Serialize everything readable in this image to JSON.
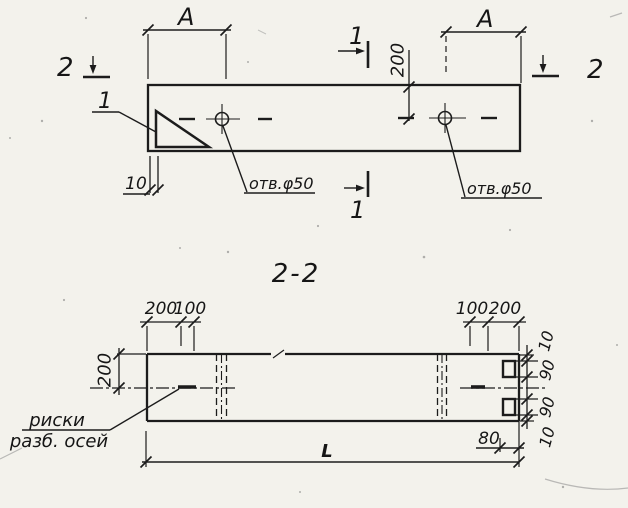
{
  "colors": {
    "paper": "#f3f2ec",
    "ink": "#1c1c1c"
  },
  "plan": {
    "dim_a_left": "A",
    "dim_a_right": "A",
    "dim_200": "200",
    "dim_10": "10",
    "detail_label": "1",
    "hole_label_left": "отв.φ50",
    "hole_label_right": "отв.φ50",
    "section1_top": "1",
    "section1_bottom": "1",
    "section2_left": "2",
    "section2_right": "2"
  },
  "section": {
    "title": "2-2",
    "dim_200_a": "200",
    "dim_100_a": "100",
    "dim_100_b": "100",
    "dim_200_b": "200",
    "dim_200_left": "200",
    "chain": {
      "c1": "10",
      "c2": "90",
      "c3": "90",
      "c4": "10"
    },
    "dim_80": "80",
    "dim_length": "L",
    "axis_note_line1": "риски",
    "axis_note_line2": "разб. осей"
  }
}
